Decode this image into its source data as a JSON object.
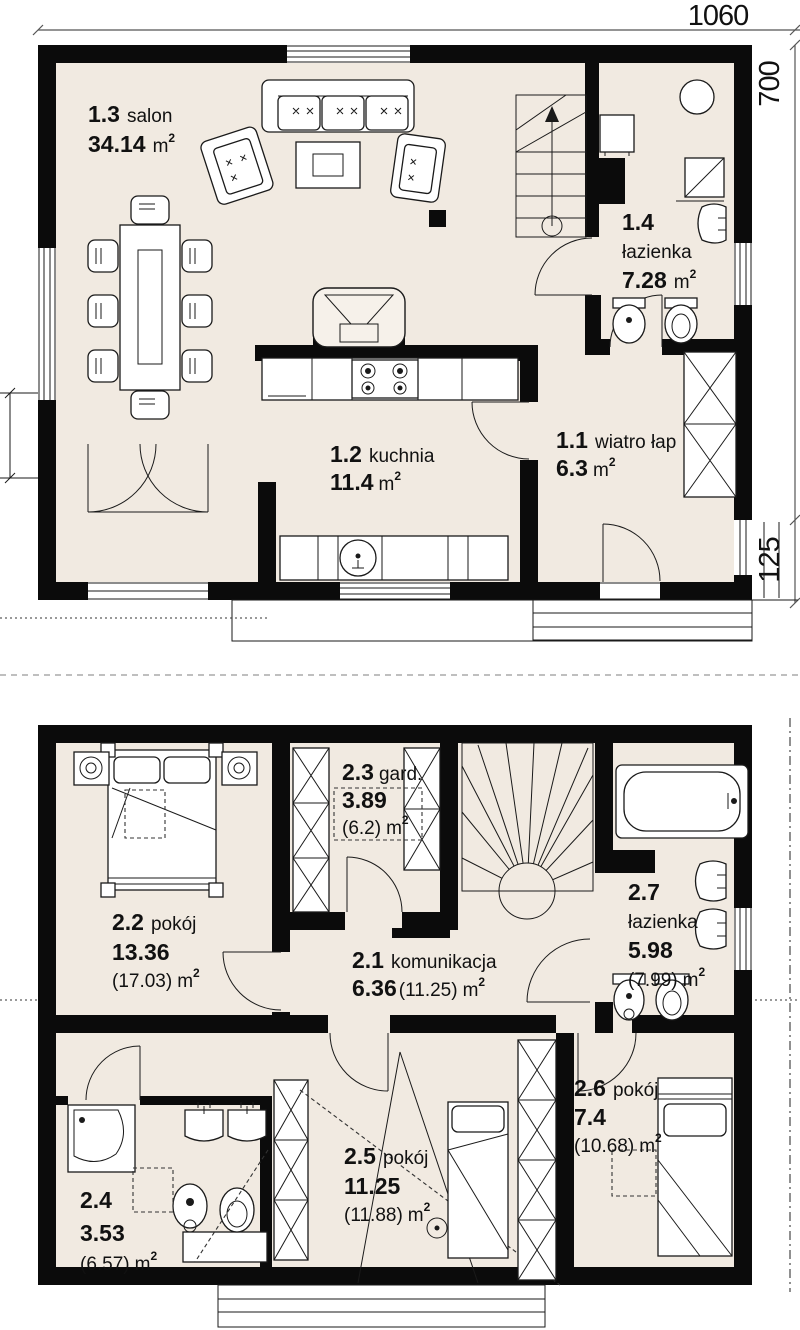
{
  "unit": "m",
  "unit_sup": "2",
  "dimensions": {
    "width_top": "1060",
    "height_right": "700",
    "step_right": "125"
  },
  "floors": [
    {
      "rooms": [
        {
          "id": "1.3",
          "name": "salon",
          "area": "34.14"
        },
        {
          "id": "1.4",
          "name": "łazienka",
          "area": "7.28"
        },
        {
          "id": "1.2",
          "name": "kuchnia",
          "area": "11.4"
        },
        {
          "id": "1.1",
          "name": "wiatro łap",
          "area": "6.3"
        }
      ]
    },
    {
      "rooms": [
        {
          "id": "2.3",
          "name": "gard.",
          "area": "3.89",
          "area_gross": "(6.2)"
        },
        {
          "id": "2.2",
          "name": "pokój",
          "area": "13.36",
          "area_gross": "(17.03)"
        },
        {
          "id": "2.1",
          "name": "komunikacja",
          "area": "6.36",
          "area_gross": "(11.25)"
        },
        {
          "id": "2.7",
          "name": "łazienka",
          "area": "5.98",
          "area_gross": "(7.99)"
        },
        {
          "id": "2.6",
          "name": "pokój",
          "area": "7.4",
          "area_gross": "(10.68)"
        },
        {
          "id": "2.5",
          "name": "pokój",
          "area": "11.25",
          "area_gross": "(11.88)"
        },
        {
          "id": "2.4",
          "name": "",
          "area": "3.53",
          "area_gross": "(6.57)"
        }
      ]
    }
  ]
}
